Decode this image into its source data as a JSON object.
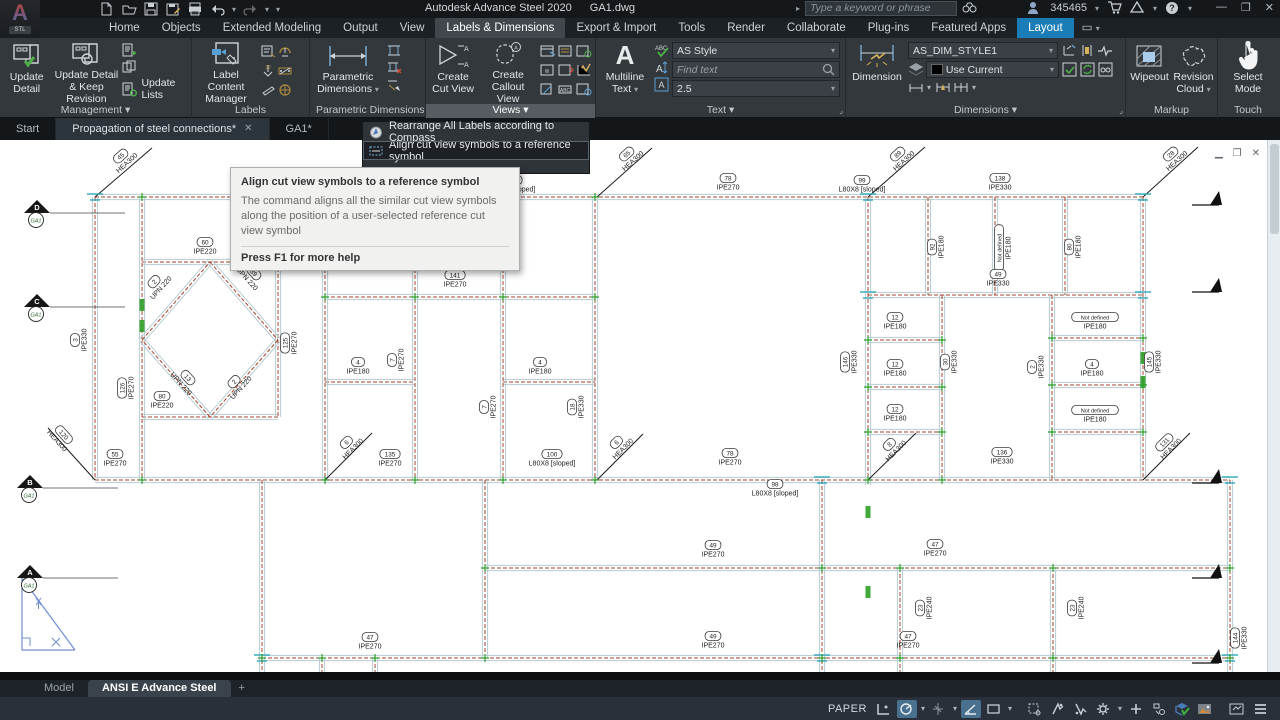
{
  "title_bar": {
    "logo_letter": "A",
    "logo_sub": "STL",
    "app_title": "Autodesk Advance Steel 2020",
    "doc_title": "GA1.dwg",
    "search_placeholder": "Type a keyword or phrase",
    "user_id": "345465",
    "minimize": "—",
    "restore": "❐",
    "close": "✕"
  },
  "menu_tabs": [
    {
      "label": "Home"
    },
    {
      "label": "Objects"
    },
    {
      "label": "Extended Modeling"
    },
    {
      "label": "Output"
    },
    {
      "label": "View"
    },
    {
      "label": "Labels & Dimensions",
      "active": true
    },
    {
      "label": "Export & Import"
    },
    {
      "label": "Tools"
    },
    {
      "label": "Render"
    },
    {
      "label": "Collaborate"
    },
    {
      "label": "Plug-ins"
    },
    {
      "label": "Featured Apps"
    },
    {
      "label": "Layout",
      "layout": true
    }
  ],
  "ribbon": {
    "management": {
      "update_detail": "Update Detail",
      "update_detail_keep": "Update Detail & Keep Revision",
      "update_lists": "Update Lists",
      "panel_label": "Management ▾"
    },
    "labels_panel": {
      "label_content_manager": "Label Content Manager",
      "panel_label": "Labels"
    },
    "parametric": {
      "button": "Parametric Dimensions",
      "panel_label": "Parametric Dimensions"
    },
    "views": {
      "create_cut_view": "Create Cut View",
      "create_callout_view": "Create Callout View",
      "panel_label": "Views ▾"
    },
    "text_panel": {
      "multiline_text": "Multiline Text",
      "style_value": "AS Style",
      "find_placeholder": "Find text",
      "height_value": "2.5",
      "panel_label": "Text ▾"
    },
    "dimensions_panel": {
      "dimension": "Dimension",
      "style_value": "AS_DIM_STYLE1",
      "layer_value": "Use Current",
      "panel_label": "Dimensions ▾"
    },
    "markup": {
      "wipeout": "Wipeout",
      "revision_cloud": "Revision Cloud",
      "panel_label": "Markup"
    },
    "touch": {
      "select_mode": "Select Mode",
      "panel_label": "Touch"
    }
  },
  "file_tabs": [
    {
      "label": "Start"
    },
    {
      "label": "Propagation of steel connections*",
      "closable": true,
      "hl": true
    },
    {
      "label": "GA1*"
    }
  ],
  "dropdown_menu": {
    "items": [
      {
        "label": "Rearrange All Labels according to Compass"
      },
      {
        "label": "Align cut view symbols to a reference symbol",
        "highlighted": true
      }
    ]
  },
  "tooltip": {
    "title": "Align cut view symbols to a reference symbol",
    "body": "The command aligns all the similar cut view symbols along the position of a user-selected reference cut view symbol",
    "footer": "Press F1 for more help"
  },
  "layout_tabs": {
    "model": "Model",
    "active": "ANSI E Advance Steel",
    "add": "+"
  },
  "status_bar": {
    "paper_label": "PAPER"
  },
  "drawing": {
    "colors": {
      "beam_edge": "#b7ccd3",
      "beam_center": "#a3432b",
      "joint": "#2e9e27",
      "cyan": "#2fa8bc",
      "black": "#1a1a1a"
    },
    "beams": [
      [
        95,
        57,
        1145,
        57
      ],
      [
        142,
        122,
        278,
        122
      ],
      [
        142,
        277,
        278,
        277
      ],
      [
        325,
        157,
        595,
        157
      ],
      [
        868,
        155,
        1143,
        155
      ],
      [
        325,
        242,
        415,
        242
      ],
      [
        503,
        242,
        595,
        242
      ],
      [
        95,
        340,
        1230,
        340
      ],
      [
        868,
        200,
        942,
        200
      ],
      [
        868,
        247,
        942,
        247
      ],
      [
        868,
        292,
        942,
        292
      ],
      [
        1052,
        198,
        1143,
        198
      ],
      [
        1052,
        245,
        1143,
        245
      ],
      [
        1052,
        292,
        1143,
        292
      ],
      [
        485,
        428,
        1230,
        428
      ],
      [
        262,
        518,
        1230,
        518
      ],
      [
        95,
        57,
        95,
        340
      ],
      [
        142,
        57,
        142,
        340
      ],
      [
        278,
        122,
        278,
        277
      ],
      [
        325,
        57,
        325,
        340
      ],
      [
        415,
        57,
        415,
        340
      ],
      [
        503,
        57,
        503,
        340
      ],
      [
        595,
        57,
        595,
        340
      ],
      [
        868,
        57,
        868,
        345
      ],
      [
        928,
        57,
        928,
        155
      ],
      [
        995,
        57,
        995,
        155
      ],
      [
        1065,
        57,
        1065,
        155
      ],
      [
        1143,
        57,
        1143,
        340
      ],
      [
        942,
        155,
        942,
        340
      ],
      [
        1052,
        155,
        1052,
        340
      ],
      [
        262,
        340,
        262,
        532
      ],
      [
        485,
        340,
        485,
        518
      ],
      [
        822,
        340,
        822,
        532
      ],
      [
        900,
        428,
        900,
        532
      ],
      [
        1053,
        428,
        1053,
        532
      ],
      [
        1230,
        340,
        1230,
        532
      ],
      [
        322,
        518,
        322,
        532
      ],
      [
        375,
        518,
        375,
        532
      ],
      [
        210,
        122,
        278,
        200
      ],
      [
        278,
        200,
        210,
        277
      ],
      [
        210,
        277,
        142,
        200
      ],
      [
        142,
        200,
        210,
        122
      ]
    ],
    "labels": [
      {
        "ref": "66",
        "profile": "IPE270",
        "x": 272,
        "y": 45
      },
      {
        "ref": "100",
        "profile": "L80X8 [sloped]",
        "x": 512,
        "y": 48
      },
      {
        "ref": "78",
        "profile": "IPE270",
        "x": 728,
        "y": 46
      },
      {
        "ref": "99",
        "profile": "L80X8 [sloped]",
        "x": 862,
        "y": 48
      },
      {
        "ref": "138",
        "profile": "IPE330",
        "x": 1000,
        "y": 46
      },
      {
        "ref": "60",
        "profile": "IPE220",
        "x": 205,
        "y": 110
      },
      {
        "ref": "80",
        "profile": "IPE220",
        "x": 162,
        "y": 264
      },
      {
        "ref": "2",
        "profile": "UPN 220",
        "x": 160,
        "y": 147,
        "rot": -48
      },
      {
        "ref": "39",
        "profile": "UPN 220",
        "x": 248,
        "y": 138,
        "rot": 48
      },
      {
        "ref": "13",
        "profile": "UPN 220",
        "x": 182,
        "y": 243,
        "rot": 48
      },
      {
        "ref": "2",
        "profile": "UPN 220",
        "x": 240,
        "y": 247,
        "rot": -48
      },
      {
        "ref": "3",
        "profile": "IPE330",
        "x": 83,
        "y": 200,
        "rot": -90
      },
      {
        "ref": "126",
        "profile": "IPE270",
        "x": 130,
        "y": 248,
        "rot": -90
      },
      {
        "ref": "125",
        "profile": "IPE270",
        "x": 293,
        "y": 203,
        "rot": -90
      },
      {
        "ref": "141",
        "profile": "IPE270",
        "x": 455,
        "y": 143
      },
      {
        "ref": "7",
        "profile": "IPE270",
        "x": 400,
        "y": 220,
        "rot": -90
      },
      {
        "ref": "7",
        "profile": "IPE270",
        "x": 492,
        "y": 267,
        "rot": -90
      },
      {
        "ref": "18",
        "profile": "IPE330",
        "x": 580,
        "y": 267,
        "rot": -90
      },
      {
        "ref": "4",
        "profile": "IPE180",
        "x": 358,
        "y": 230
      },
      {
        "ref": "4",
        "profile": "IPE180",
        "x": 540,
        "y": 230
      },
      {
        "ref": "55",
        "profile": "IPE270",
        "x": 115,
        "y": 322
      },
      {
        "ref": "135",
        "profile": "IPE270",
        "x": 390,
        "y": 322
      },
      {
        "ref": "100",
        "profile": "L80X8 [sloped]",
        "x": 552,
        "y": 322
      },
      {
        "ref": "78",
        "profile": "IPE270",
        "x": 730,
        "y": 321
      },
      {
        "ref": "98",
        "profile": "L80X8 [sloped]",
        "x": 775,
        "y": 352
      },
      {
        "ref": "12",
        "profile": "IPE180",
        "x": 895,
        "y": 185
      },
      {
        "ref": "12",
        "profile": "IPE180",
        "x": 895,
        "y": 232
      },
      {
        "ref": "12",
        "profile": "IPE180",
        "x": 895,
        "y": 277
      },
      {
        "ref": "146",
        "profile": "IPE330",
        "x": 853,
        "y": 222,
        "rot": -90
      },
      {
        "ref": "30",
        "profile": "IPE330",
        "x": 953,
        "y": 222,
        "rot": -90
      },
      {
        "ref": "92",
        "profile": "IPE180",
        "x": 940,
        "y": 107,
        "rot": -90
      },
      {
        "ref": "Not defined",
        "profile": "IPE180",
        "x": 1007,
        "y": 108,
        "rot": -90
      },
      {
        "ref": "80",
        "profile": "IPE180",
        "x": 1077,
        "y": 107,
        "rot": -90
      },
      {
        "ref": "49",
        "profile": "IPE330",
        "x": 998,
        "y": 142
      },
      {
        "ref": "Not defined",
        "profile": "IPE180",
        "x": 1095,
        "y": 185
      },
      {
        "ref": "2",
        "profile": "IPE330",
        "x": 1040,
        "y": 227,
        "rot": -90
      },
      {
        "ref": "4",
        "profile": "IPE180",
        "x": 1092,
        "y": 232
      },
      {
        "ref": "Not defined",
        "profile": "IPE180",
        "x": 1095,
        "y": 278
      },
      {
        "ref": "145",
        "profile": "IPE330",
        "x": 1157,
        "y": 222,
        "rot": -90
      },
      {
        "ref": "136",
        "profile": "IPE330",
        "x": 1002,
        "y": 320
      },
      {
        "ref": "49",
        "profile": "IPE270",
        "x": 713,
        "y": 413
      },
      {
        "ref": "47",
        "profile": "IPE270",
        "x": 935,
        "y": 412
      },
      {
        "ref": "47",
        "profile": "IPE270",
        "x": 370,
        "y": 505
      },
      {
        "ref": "49",
        "profile": "IPE270",
        "x": 713,
        "y": 504
      },
      {
        "ref": "47",
        "profile": "IPE270",
        "x": 908,
        "y": 504
      },
      {
        "ref": "23",
        "profile": "IPE240",
        "x": 928,
        "y": 468,
        "rot": -90
      },
      {
        "ref": "23",
        "profile": "IPE240",
        "x": 1080,
        "y": 468,
        "rot": -90
      },
      {
        "ref": "144",
        "profile": "IPE330",
        "x": 1243,
        "y": 498,
        "rot": -90
      }
    ],
    "braces": [
      {
        "line": [
          95,
          57,
          152,
          8
        ],
        "ref": "45",
        "profile": "HEA300",
        "lx": 126,
        "ly": 22,
        "rot": -42
      },
      {
        "line": [
          597,
          57,
          652,
          8
        ],
        "ref": "65",
        "profile": "HEA300",
        "lx": 632,
        "ly": 20,
        "rot": -42
      },
      {
        "line": [
          868,
          57,
          925,
          7
        ],
        "ref": "89",
        "profile": "HEA300",
        "lx": 903,
        "ly": 20,
        "rot": -42
      },
      {
        "line": [
          1143,
          57,
          1198,
          7
        ],
        "ref": "28",
        "profile": "HEA300",
        "lx": 1176,
        "ly": 20,
        "rot": -42
      },
      {
        "line": [
          95,
          340,
          48,
          288
        ],
        "ref": "120",
        "profile": "HEA300",
        "lx": 58,
        "ly": 300,
        "rot": 48
      },
      {
        "line": [
          325,
          340,
          372,
          293
        ],
        "ref": "6",
        "profile": "HEA300",
        "lx": 352,
        "ly": 308,
        "rot": -45
      },
      {
        "line": [
          597,
          340,
          643,
          294
        ],
        "ref": "6",
        "profile": "HEA300",
        "lx": 622,
        "ly": 308,
        "rot": -45
      },
      {
        "line": [
          868,
          340,
          916,
          293
        ],
        "ref": "8",
        "profile": "HEA300",
        "lx": 895,
        "ly": 310,
        "rot": -45
      },
      {
        "line": [
          1143,
          340,
          1190,
          293
        ],
        "ref": "131",
        "profile": "HEA300",
        "lx": 1170,
        "ly": 308,
        "rot": -45
      }
    ],
    "grid_bubbles": [
      {
        "letter": "D",
        "sub": "GA1",
        "x": 37,
        "y": 73
      },
      {
        "letter": "C",
        "sub": "GA1",
        "x": 37,
        "y": 167
      },
      {
        "letter": "B",
        "sub": "GA1",
        "x": 30,
        "y": 348
      },
      {
        "letter": "A",
        "sub": "GA1",
        "x": 30,
        "y": 438
      }
    ],
    "section_markers": [
      {
        "x": 1192,
        "y": 65
      },
      {
        "x": 1192,
        "y": 152
      },
      {
        "x": 1192,
        "y": 343
      },
      {
        "x": 1192,
        "y": 438
      },
      {
        "x": 1192,
        "y": 523
      }
    ],
    "joints": [
      [
        142,
        57
      ],
      [
        325,
        57
      ],
      [
        415,
        57
      ],
      [
        503,
        57
      ],
      [
        595,
        57
      ],
      [
        325,
        157
      ],
      [
        415,
        157
      ],
      [
        503,
        157
      ],
      [
        595,
        157
      ],
      [
        142,
        340
      ],
      [
        325,
        340
      ],
      [
        415,
        340
      ],
      [
        503,
        340
      ],
      [
        595,
        340
      ],
      [
        868,
        340
      ],
      [
        942,
        340
      ],
      [
        868,
        200
      ],
      [
        868,
        247
      ],
      [
        868,
        292
      ],
      [
        942,
        200
      ],
      [
        942,
        247
      ],
      [
        942,
        292
      ],
      [
        1052,
        198
      ],
      [
        1052,
        245
      ],
      [
        1052,
        292
      ],
      [
        1143,
        198
      ],
      [
        1143,
        245
      ],
      [
        1143,
        292
      ],
      [
        485,
        428
      ],
      [
        822,
        428
      ],
      [
        900,
        428
      ],
      [
        1053,
        428
      ],
      [
        1230,
        428
      ],
      [
        262,
        518
      ],
      [
        485,
        518
      ],
      [
        822,
        518
      ],
      [
        900,
        518
      ],
      [
        1053,
        518
      ],
      [
        1230,
        518
      ],
      [
        322,
        518
      ],
      [
        375,
        518
      ]
    ],
    "connectors": [
      [
        142,
        165
      ],
      [
        142,
        186
      ],
      [
        1143,
        218
      ],
      [
        1143,
        242
      ],
      [
        868,
        372
      ],
      [
        868,
        452
      ]
    ],
    "cyan_ticks": [
      [
        95,
        57
      ],
      [
        503,
        57
      ],
      [
        868,
        57
      ],
      [
        1143,
        57
      ],
      [
        822,
        340
      ],
      [
        1230,
        340
      ],
      [
        262,
        518
      ],
      [
        822,
        518
      ],
      [
        1230,
        518
      ],
      [
        868,
        155
      ],
      [
        1143,
        155
      ]
    ]
  }
}
